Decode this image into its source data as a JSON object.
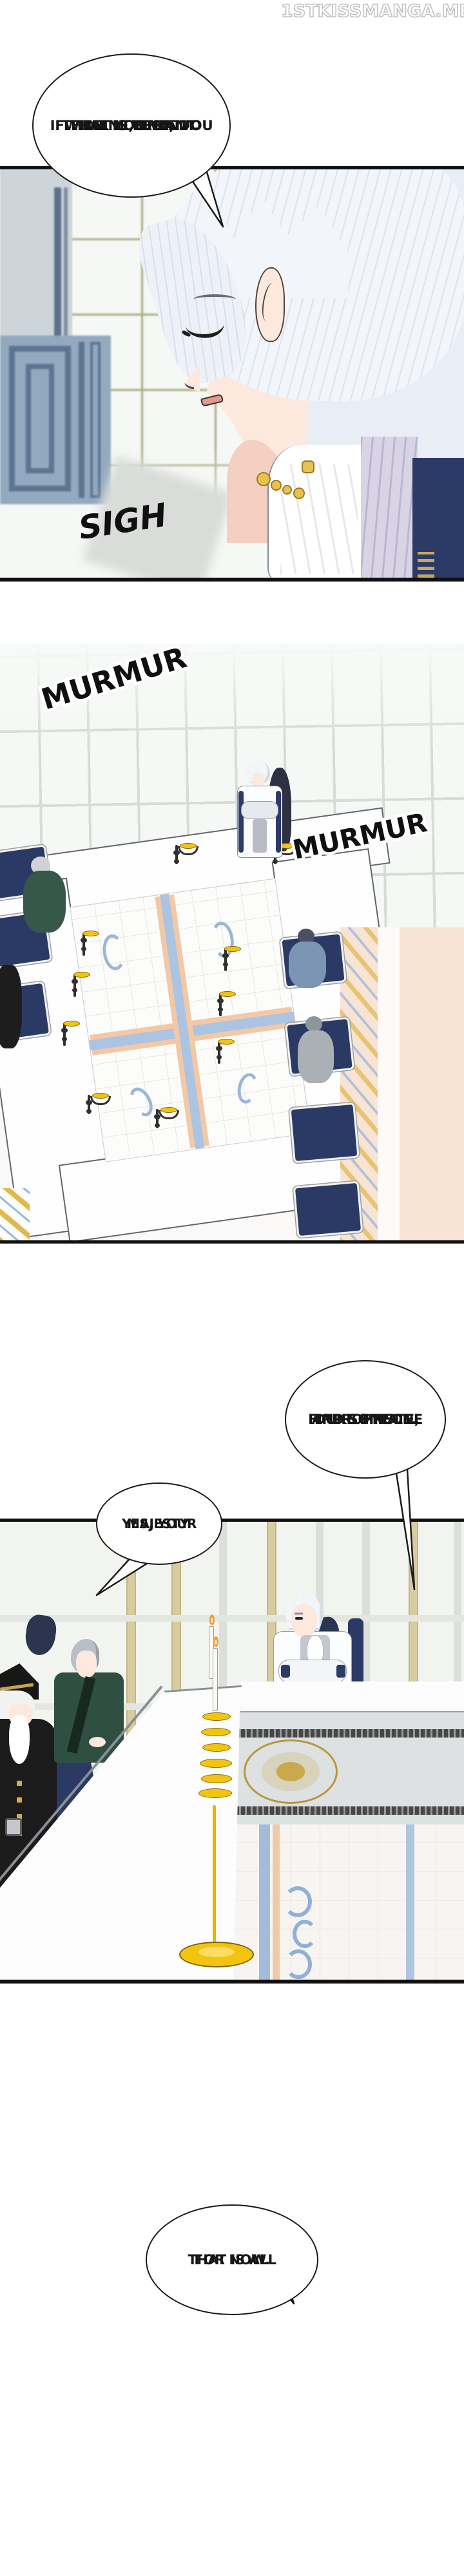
{
  "watermark": {
    "text": "1STKISSMANGA.ME"
  },
  "bubbles": {
    "b1": {
      "lines": [
        "...FINE, THEN.",
        "IF THAT IS WHAT YOU",
        "THINK IS BEST, DO",
        "WHAT YOU WANT."
      ]
    },
    "b2": {
      "lines": [
        "FIND SOMEONE",
        "APPROPRIATE,",
        "DUKE EINSLE."
      ]
    },
    "b3": {
      "lines": [
        "YES, YOUR",
        "MAJESTY."
      ]
    },
    "b4": {
      "lines": [
        "THAT IS ALL",
        "FOR NOW."
      ]
    }
  },
  "sfx": {
    "sigh": "SIGH",
    "murmur1": "MURMUR",
    "murmur2": "MURMUR"
  },
  "colors": {
    "paper": "#ffffff",
    "ink": "#101010",
    "window_olive": "#9a9a68",
    "window_gray": "#d7dcd7",
    "mullion_tan": "#d8cba0",
    "wall_blue_pattern": "#93a9c0",
    "hair_white": "#f2f5fa",
    "skin": "#fde8dd",
    "blush": "#f7cdc2",
    "lavender_collar": "#d9d3e6",
    "navy_coat": "#2c3a66",
    "green_uniform": "#2f4f42",
    "chair_navy": "#2b3a64",
    "candle_gold": "#f2c410",
    "jewelry_gold": "#e8c14e",
    "floor_blue_band": "#a3bcda",
    "floor_peach_band": "#f2c9a8",
    "carpet_gray": "#dde1e2",
    "marble_peach": "#f8e4d5"
  }
}
